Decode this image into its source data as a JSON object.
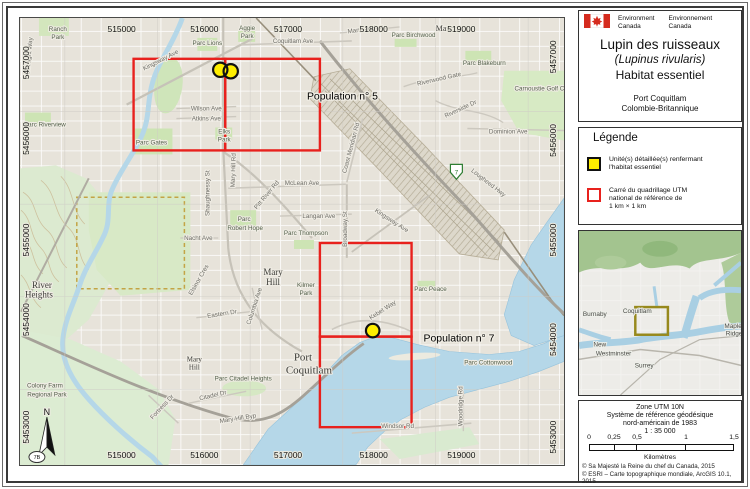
{
  "header": {
    "org_left": [
      "Environment",
      "Canada"
    ],
    "org_right": [
      "Environnement",
      "Canada"
    ],
    "title_line1": "Lupin des ruisseaux",
    "title_line2": "(Lupinus rivularis)",
    "title_line3": "Habitat essentiel",
    "location_line1": "Port Coquitlam",
    "location_line2": "Colombie-Britannique"
  },
  "legend": {
    "title": "Légende",
    "items": [
      {
        "swatch": "habitat",
        "lines": [
          "Unité(s) détaillée(s) renfermant",
          "l'habitat essentiel"
        ]
      },
      {
        "swatch": "utm-grid",
        "lines": [
          "Carré du quadrillage UTM",
          "national de référence de",
          "1 km × 1 km"
        ]
      }
    ]
  },
  "info": {
    "lines": [
      "Zone UTM 10N",
      "Système de référence géodésique",
      "nord-américain de 1983",
      "1 : 35 000"
    ],
    "scale": {
      "ticks": [
        {
          "label": "0",
          "off": 0
        },
        {
          "label": "0,25",
          "off": 25
        },
        {
          "label": "0,5",
          "off": 48
        },
        {
          "label": "1",
          "off": 97
        },
        {
          "label": "1,5",
          "off": 145
        }
      ],
      "segments": [
        25,
        23,
        49,
        48
      ],
      "unit": "Kilomètres"
    },
    "credits": [
      "© Sa Majesté la Reine du chef du Canada, 2015",
      "© ESRI – Carte topographique mondiale, ArcGIS 10.1, 2015"
    ]
  },
  "map": {
    "north_label": "N",
    "axis": {
      "top": [
        {
          "t": "515000",
          "x": 121
        },
        {
          "t": "516000",
          "x": 204
        },
        {
          "t": "517000",
          "x": 288
        },
        {
          "t": "518000",
          "x": 374
        },
        {
          "t": "519000",
          "x": 462
        }
      ],
      "bottom": [
        {
          "t": "515000",
          "x": 121
        },
        {
          "t": "516000",
          "x": 204
        },
        {
          "t": "517000",
          "x": 288
        },
        {
          "t": "518000",
          "x": 374
        },
        {
          "t": "519000",
          "x": 462
        }
      ],
      "left": [
        {
          "t": "5457000",
          "y": 62
        },
        {
          "t": "5456000",
          "y": 138
        },
        {
          "t": "5455000",
          "y": 240
        },
        {
          "t": "5454000",
          "y": 320
        },
        {
          "t": "5453000",
          "y": 428
        }
      ],
      "right": [
        {
          "t": "5457000",
          "y": 56
        },
        {
          "t": "5456000",
          "y": 140
        },
        {
          "t": "5455000",
          "y": 240
        },
        {
          "t": "5454000",
          "y": 340
        },
        {
          "t": "5453000",
          "y": 438
        }
      ]
    },
    "populations": [
      {
        "label": "Population n° 5",
        "x": 307,
        "y": 99
      },
      {
        "label": "Population n° 7",
        "x": 424,
        "y": 342
      }
    ],
    "utm_squares": [
      {
        "x": 133,
        "y": 58,
        "w": 92,
        "h": 92
      },
      {
        "x": 225,
        "y": 58,
        "w": 95,
        "h": 92
      },
      {
        "x": 320,
        "y": 243,
        "w": 92,
        "h": 94
      },
      {
        "x": 320,
        "y": 337,
        "w": 92,
        "h": 91
      }
    ],
    "habitat_points": [
      {
        "x": 220,
        "y": 69,
        "r": 7.2
      },
      {
        "x": 230.5,
        "y": 70.5,
        "r": 7.2
      },
      {
        "x": 373,
        "y": 331,
        "r": 6.8
      }
    ],
    "shields": [
      {
        "label": "7B",
        "x": 36,
        "y": 460,
        "kind": "oval"
      },
      {
        "label": "7",
        "x": 457,
        "y": 174,
        "kind": "crown"
      }
    ],
    "labels": {
      "streets": [
        {
          "t": "Kingsway Ave",
          "x": 161,
          "y": 61,
          "r": -27
        },
        {
          "t": "Manning Ave",
          "x": 366,
          "y": 30,
          "r": -8
        },
        {
          "t": "Coquitlam Ave",
          "x": 293,
          "y": 42,
          "r": 0
        },
        {
          "t": "Riverwood Gate",
          "x": 440,
          "y": 80,
          "r": -13
        },
        {
          "t": "Riverside Dr",
          "x": 462,
          "y": 110,
          "r": -25
        },
        {
          "t": "Dominion Ave",
          "x": 509,
          "y": 133,
          "r": 0
        },
        {
          "t": "Wilson Ave",
          "x": 206,
          "y": 110,
          "r": 0
        },
        {
          "t": "Atkins Ave",
          "x": 206,
          "y": 120,
          "r": 0
        },
        {
          "t": "McLean Ave",
          "x": 302,
          "y": 185,
          "r": 0
        },
        {
          "t": "Langan Ave",
          "x": 319,
          "y": 218,
          "r": 0
        },
        {
          "t": "Nacht Ave",
          "x": 198,
          "y": 240,
          "r": 0
        },
        {
          "t": "Shaughnessy St",
          "x": 209,
          "y": 193,
          "r": -90
        },
        {
          "t": "Mary Hill Rd",
          "x": 235,
          "y": 170,
          "r": -88
        },
        {
          "t": "Pitt River Rd",
          "x": 268,
          "y": 196,
          "r": -50
        },
        {
          "t": "Broadway St",
          "x": 347,
          "y": 229,
          "r": -90
        },
        {
          "t": "Coast Meridian Rd",
          "x": 353,
          "y": 148,
          "r": -75
        },
        {
          "t": "Lougheed Hwy",
          "x": 488,
          "y": 184,
          "r": 38
        },
        {
          "t": "Kingsway Ave",
          "x": 391,
          "y": 222,
          "r": 33
        },
        {
          "t": "Eastern Dr",
          "x": 222,
          "y": 316,
          "r": -9
        },
        {
          "t": "Columbia Ave",
          "x": 256,
          "y": 307,
          "r": -72
        },
        {
          "t": "Elsinor Cres",
          "x": 200,
          "y": 281,
          "r": -60
        },
        {
          "t": "Citadel Dr",
          "x": 213,
          "y": 398,
          "r": -13
        },
        {
          "t": "Fortress Dr",
          "x": 163,
          "y": 409,
          "r": -47
        },
        {
          "t": "Mary Hill Byp",
          "x": 238,
          "y": 421,
          "r": -9
        },
        {
          "t": "Windsor Rd",
          "x": 398,
          "y": 429,
          "r": 0
        },
        {
          "t": "Woodridge Rd",
          "x": 463,
          "y": 407,
          "r": -90
        },
        {
          "t": "Kebet Way",
          "x": 384,
          "y": 312,
          "r": -33
        },
        {
          "t": "Starlight Way",
          "x": 30,
          "y": 55,
          "r": -85
        }
      ],
      "parks": [
        {
          "t": "Ranch",
          "x": 57,
          "y": 30
        },
        {
          "t": "Park",
          "x": 57,
          "y": 38
        },
        {
          "t": "Parc Riverview",
          "x": 44,
          "y": 126
        },
        {
          "t": "Parc Gates",
          "x": 151,
          "y": 144
        },
        {
          "t": "Parc Lions",
          "x": 207,
          "y": 44
        },
        {
          "t": "Aggie",
          "x": 247,
          "y": 29
        },
        {
          "t": "Park",
          "x": 247,
          "y": 37
        },
        {
          "t": "Parc Birchwood",
          "x": 414,
          "y": 36
        },
        {
          "t": "Parc Blakeburn",
          "x": 485,
          "y": 64
        },
        {
          "t": "Carnoustie Golf Cl",
          "x": 541,
          "y": 90
        },
        {
          "t": "Elks",
          "x": 224,
          "y": 133
        },
        {
          "t": "Park",
          "x": 224,
          "y": 141
        },
        {
          "t": "Parc",
          "x": 244,
          "y": 221
        },
        {
          "t": "Robert Hope",
          "x": 245,
          "y": 230
        },
        {
          "t": "Parc Thompson",
          "x": 306,
          "y": 235
        },
        {
          "t": "Kilmer",
          "x": 306,
          "y": 287
        },
        {
          "t": "Park",
          "x": 306,
          "y": 295
        },
        {
          "t": "Parc Peace",
          "x": 431,
          "y": 291
        },
        {
          "t": "Parc Cottonwood",
          "x": 489,
          "y": 365
        },
        {
          "t": "Parc Citadel Heights",
          "x": 243,
          "y": 381
        },
        {
          "t": "Colony Farm",
          "x": 44,
          "y": 388
        },
        {
          "t": "Regional Park",
          "x": 46,
          "y": 397
        }
      ],
      "places": [
        {
          "t": "Manor",
          "x": 447,
          "y": 30,
          "s": 8
        },
        {
          "t": "Mary",
          "x": 273,
          "y": 275,
          "s": 9
        },
        {
          "t": "Hill",
          "x": 273,
          "y": 285,
          "s": 9
        },
        {
          "t": "Mary",
          "x": 194,
          "y": 362,
          "s": 7
        },
        {
          "t": "Hill",
          "x": 194,
          "y": 370,
          "s": 7
        },
        {
          "t": "River",
          "x": 41,
          "y": 288,
          "s": 9
        },
        {
          "t": "Heights",
          "x": 38,
          "y": 298,
          "s": 9
        },
        {
          "t": "Port",
          "x": 303,
          "y": 361,
          "s": 11
        },
        {
          "t": "Coquitlam",
          "x": 309,
          "y": 374,
          "s": 11
        }
      ]
    }
  },
  "inset": {
    "extent_box": {
      "x": 635,
      "y": 307,
      "w": 33,
      "h": 28
    },
    "labels": [
      {
        "t": "Burnaby",
        "x": 594,
        "y": 316
      },
      {
        "t": "Coquitlam",
        "x": 637,
        "y": 313
      },
      {
        "t": "New",
        "x": 599,
        "y": 347
      },
      {
        "t": "Westminster",
        "x": 613,
        "y": 356
      },
      {
        "t": "Surrey",
        "x": 644,
        "y": 368
      },
      {
        "t": "Maple",
        "x": 734,
        "y": 328
      },
      {
        "t": "Ridge",
        "x": 735,
        "y": 336
      }
    ]
  },
  "colors": {
    "utm_red": "#e8211d",
    "habitat_yellow": "#ffee00",
    "water": "#b5d7e8",
    "park_green": "#cde4b4",
    "inset_extent": "#97891c"
  }
}
